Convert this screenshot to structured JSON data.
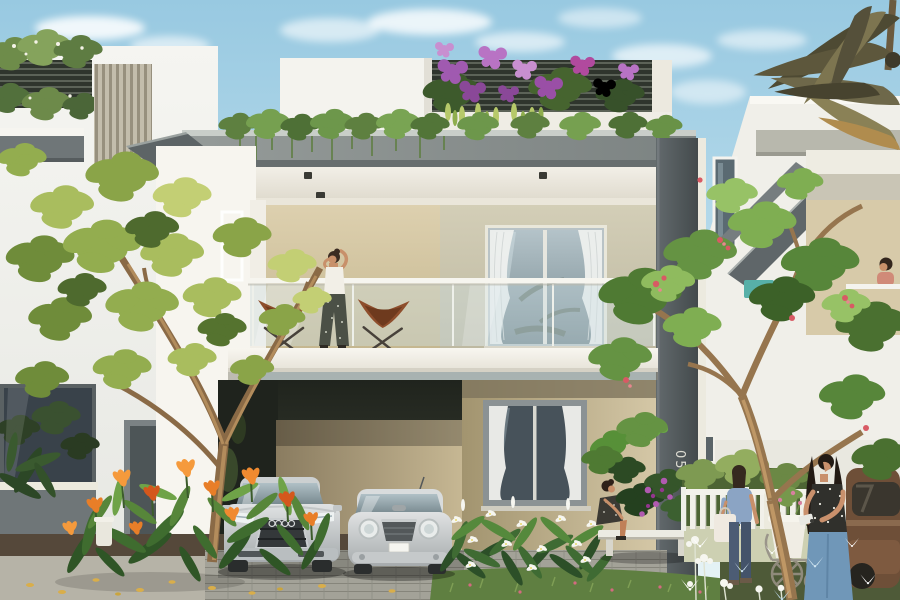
{
  "scene": {
    "type": "3d-architectural-rendering",
    "setting": "modern two-storey villa community, daytime, blue sky with light clouds",
    "house_number": "05",
    "license_plate_text": "",
    "main_villa": {
      "floors": 2,
      "features": [
        "rooftop garden with purple bougainvillea",
        "dark slatted privacy screen",
        "trailing vines along roof edge",
        "glass-railed balcony with two brown butterfly chairs",
        "beige accent walls",
        "curtained picture windows",
        "double carport",
        "white garden bench"
      ]
    },
    "vehicles": [
      {
        "name": "silver-sedan",
        "color": "#c9ccce"
      },
      {
        "name": "silver-mini-hatchback",
        "color": "#d3d6d7"
      },
      {
        "name": "brown-suv",
        "color": "#775640"
      }
    ],
    "people": [
      {
        "name": "woman-on-balcony",
        "action": "standing between butterfly chairs talking on phone"
      },
      {
        "name": "seated-woman",
        "action": "sitting on white bench beside planting bed"
      },
      {
        "name": "tote-bag-woman",
        "action": "walking near picket fence carrying white tote"
      },
      {
        "name": "phone-woman",
        "action": "standing in right foreground reading phone"
      },
      {
        "name": "right-balcony-woman",
        "action": "leaning on neighbouring balcony rail"
      }
    ],
    "vegetation": [
      "frangipani trees",
      "orange canna flowers",
      "white lilies",
      "purple orchids",
      "palm fronds",
      "picket-fence shrubs",
      "white flowers with butterflies"
    ],
    "palette": {
      "sky_top": "#9ccbe2",
      "sky_bottom": "#e8f3f6",
      "wall_white": "#f3f2ec",
      "wall_beige": "#d8cbaa",
      "wall_olive": "#ccc7b0",
      "fascia_gray": "#8b9191",
      "pillar_gray": "#555c5e",
      "leaf_green": "#6f9447",
      "flower_purple": "#a05ab0",
      "flower_orange": "#e87e28",
      "chair_brown": "#8e4e2c"
    }
  }
}
